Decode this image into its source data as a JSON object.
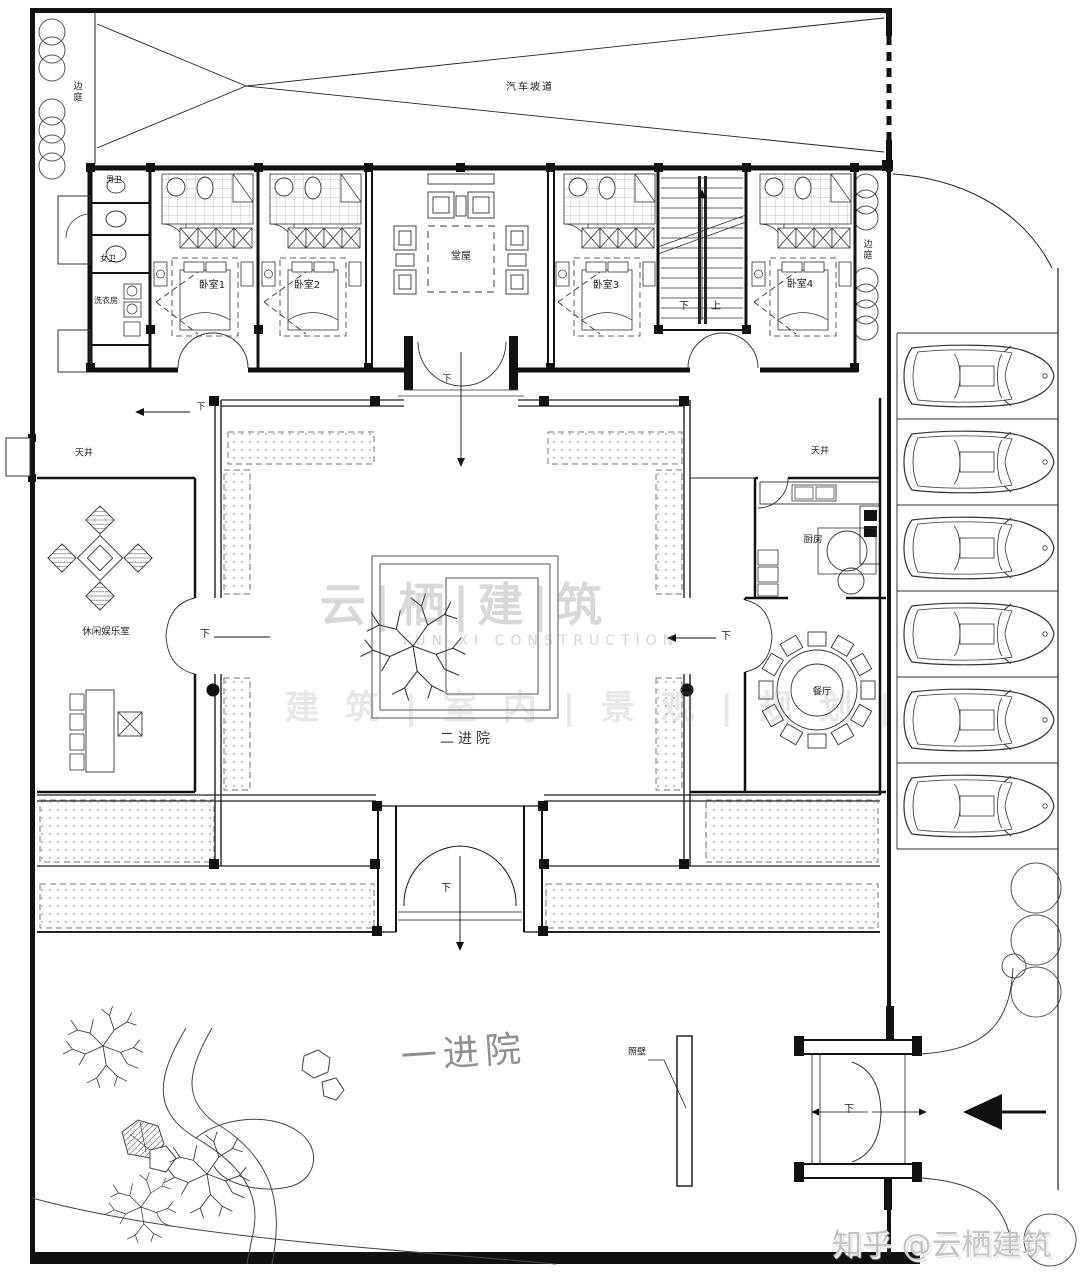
{
  "plan": {
    "ramp": "汽车坡道",
    "side_court_left": "边庭",
    "side_court_right": "边庭",
    "rooms": {
      "mens_bath": "男卫",
      "womens_bath": "女卫",
      "laundry": "洗衣房",
      "bedroom1": "卧室1",
      "bedroom2": "卧室2",
      "bedroom3": "卧室3",
      "bedroom4": "卧室4",
      "hall": "堂屋",
      "leisure": "休闲娱乐室",
      "kitchen": "厨房",
      "dining": "餐厅"
    },
    "courts": {
      "lightwell_left": "天井",
      "lightwell_right": "天井",
      "courtyard2": "二进院",
      "courtyard1": "一进院",
      "screen_wall": "照壁"
    },
    "nav": {
      "down": "下",
      "up": "上"
    }
  },
  "watermark": {
    "brand": "云|栖|建|筑",
    "brand_en": "YUN XI CONSTRUCTION",
    "services": "建 筑 | 室 内 | 景 观 | 规 划 |",
    "credit": "知乎 @云栖建筑"
  }
}
